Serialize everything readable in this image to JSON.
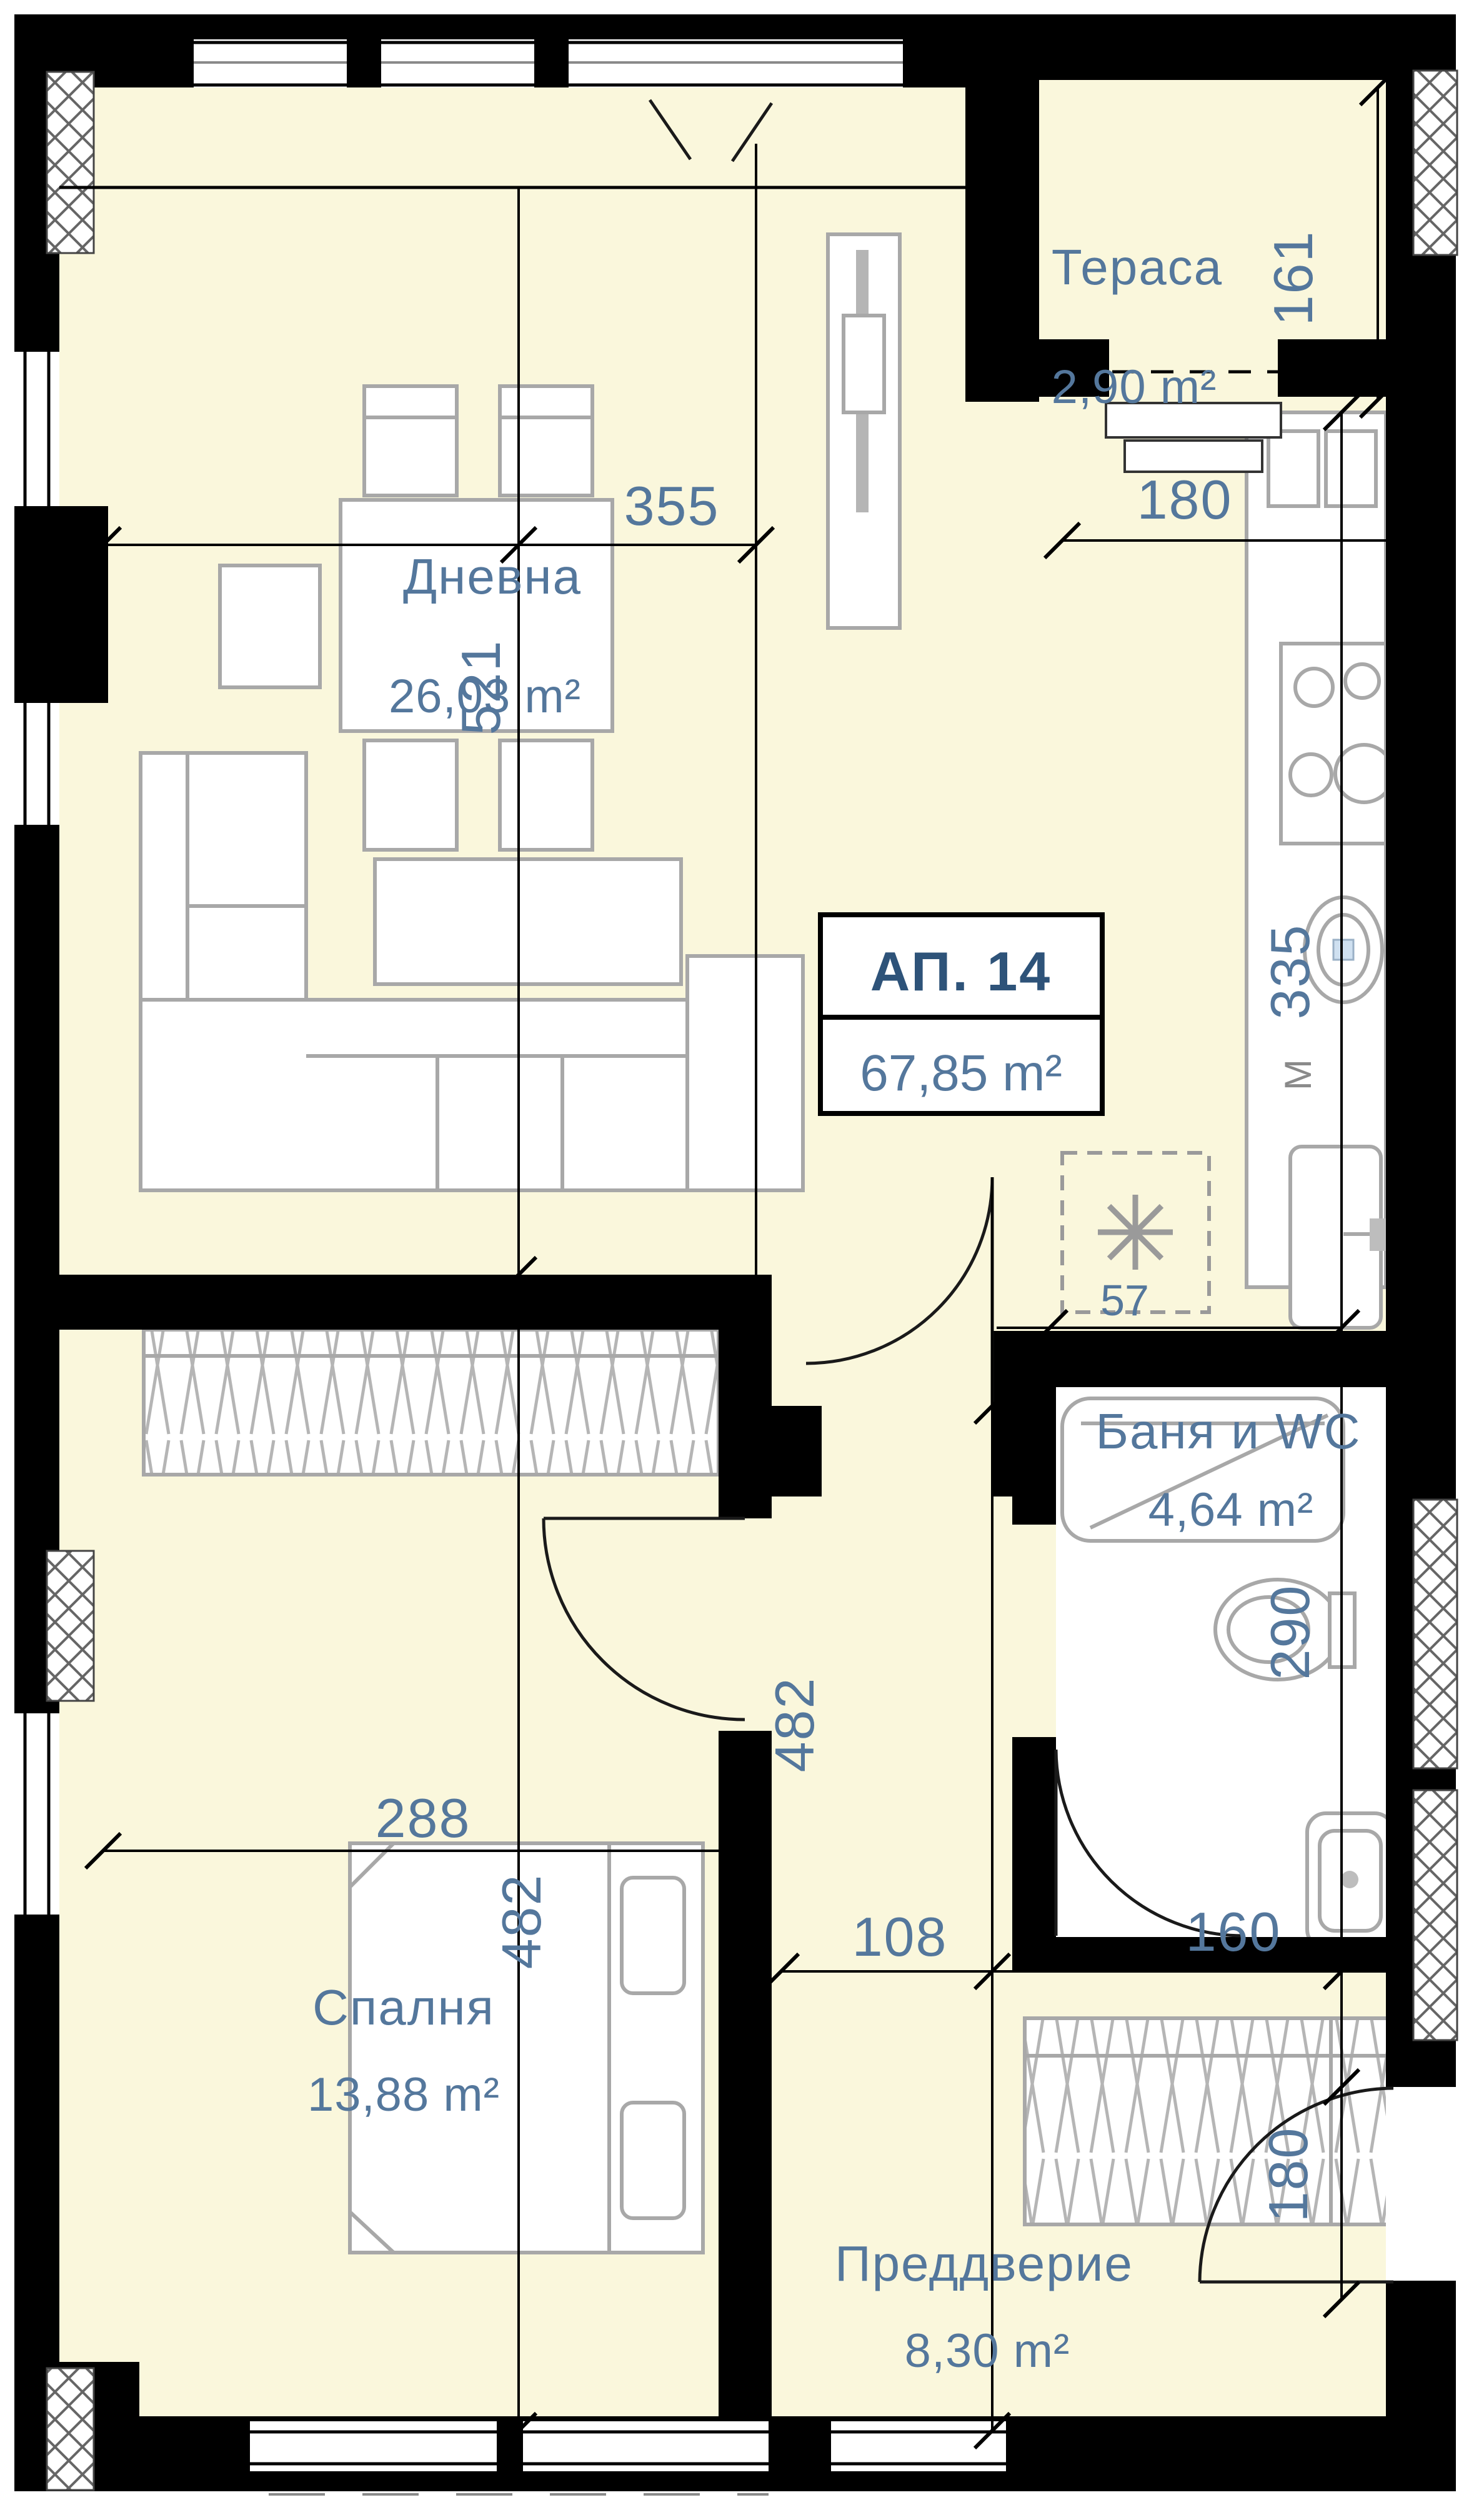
{
  "plan": {
    "unit": {
      "label": "АП. 14",
      "area": "67,85 m²"
    },
    "rooms": {
      "living": {
        "name": "Дневна",
        "area": "26,03 m²"
      },
      "terrace": {
        "name": "Тераса",
        "area": "2,90 m²"
      },
      "bathroom": {
        "name": "Баня и WC",
        "area": "4,64 m²"
      },
      "bedroom": {
        "name": "Спалня",
        "area": "13,88 m²"
      },
      "hall": {
        "name": "Преддверие",
        "area": "8,30 m²"
      }
    },
    "dims": {
      "living_width": "355",
      "living_height": "521",
      "terrace_side": "161",
      "terrace_width": "180",
      "kitchen_run": "335",
      "kitchen_mark": "M",
      "kitchen_offset": "57",
      "bathroom_run": "290",
      "bedroom_width": "288",
      "bedroom_height": "482",
      "hall_height": "482",
      "hall_split_left": "108",
      "hall_split_right": "160",
      "entry_clearance": "180"
    },
    "colors": {
      "floor": "#faf7dc",
      "wall": "#000000",
      "furniture_stroke": "#a8a8a8",
      "text": "#54779c",
      "unit_title": "#2e5379"
    }
  }
}
